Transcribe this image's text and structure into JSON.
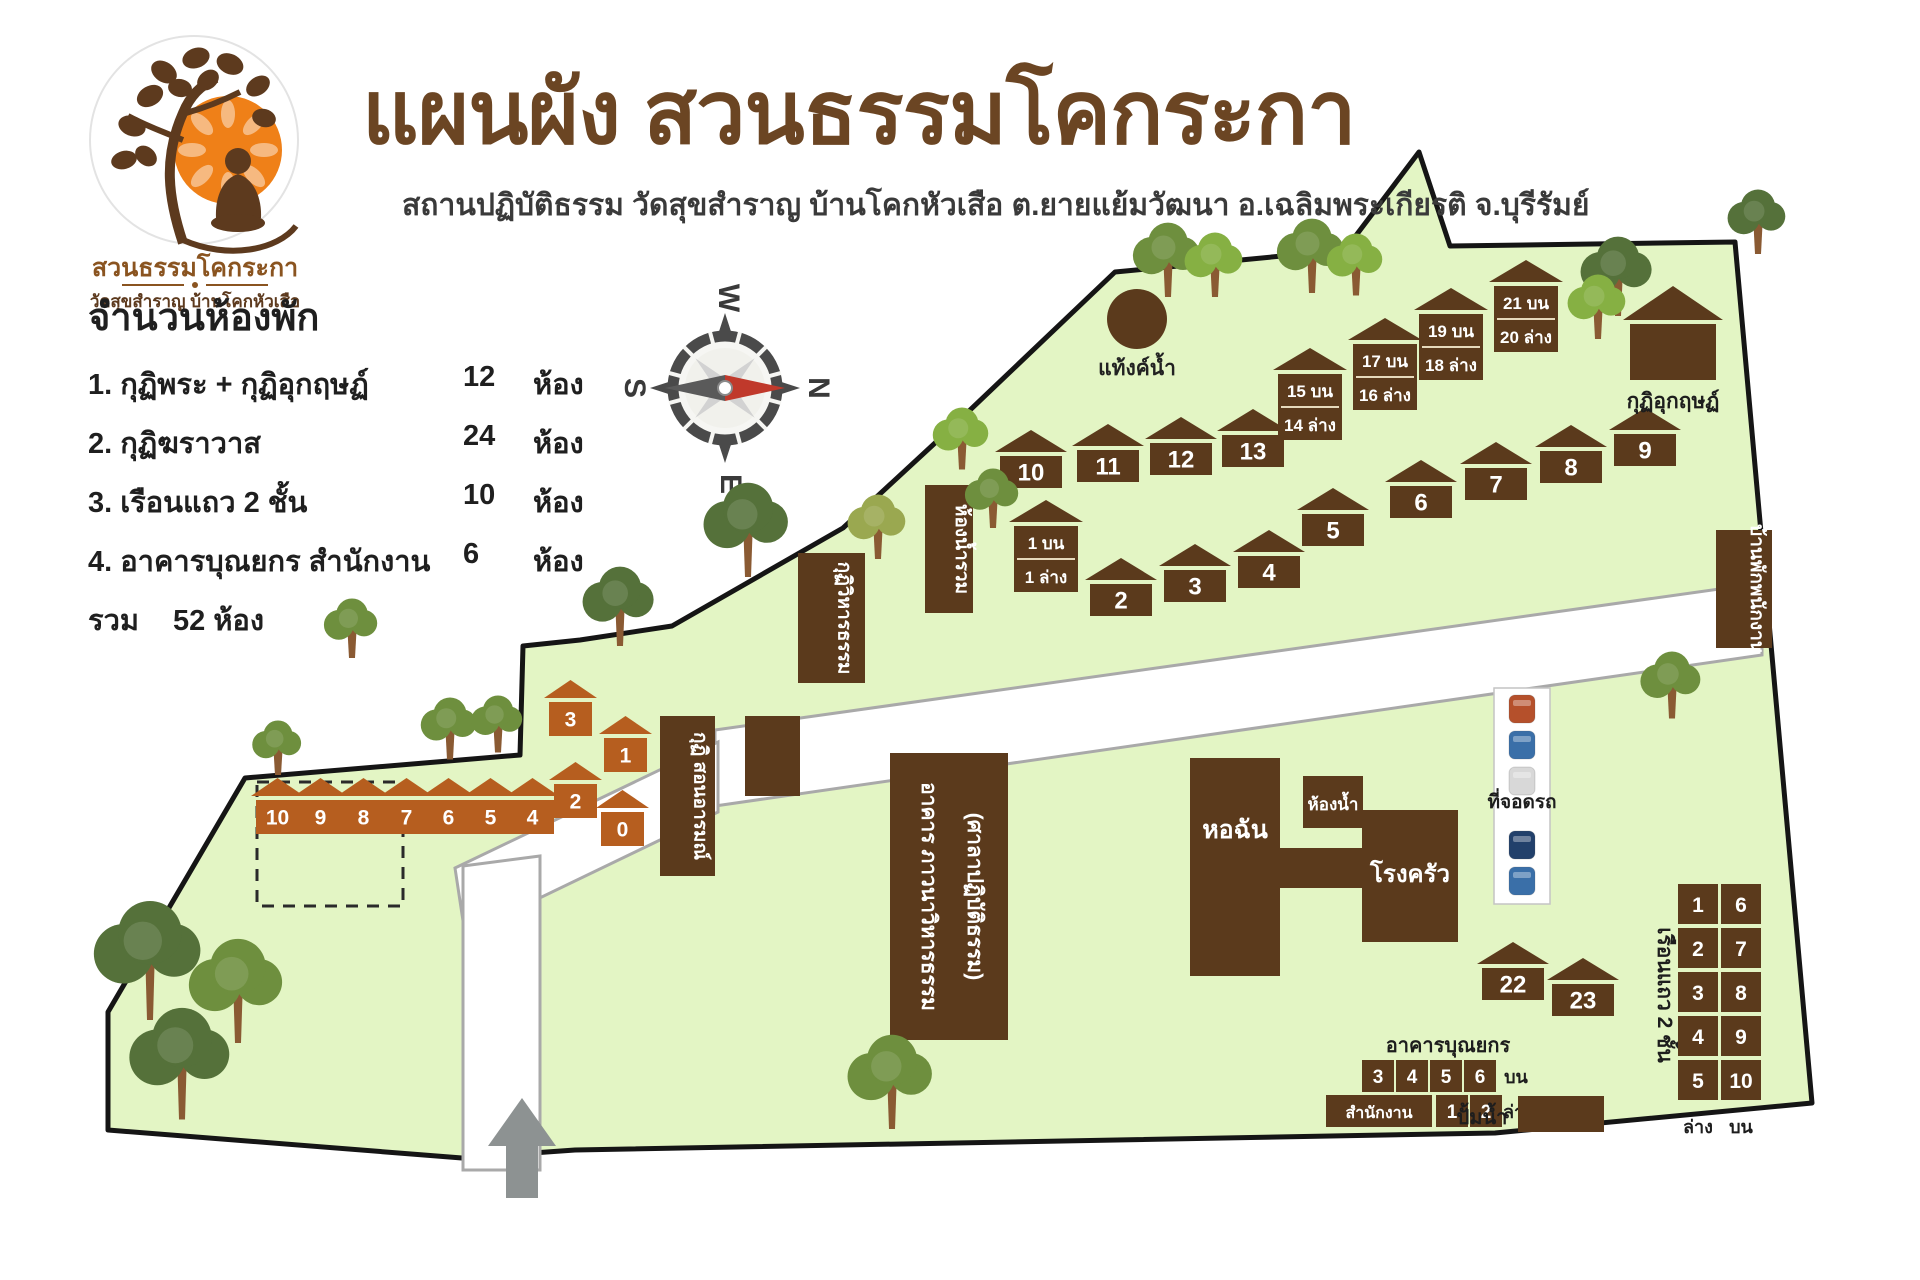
{
  "header": {
    "title": "แผนผัง สวนธรรมโคกระกา",
    "subtitle": "สถานปฏิบัติธรรม วัดสุขสำราญ บ้านโคกหัวเสือ ต.ยายแย้มวัฒนา อ.เฉลิมพระเกียรติ จ.บุรีรัมย์",
    "logo": {
      "name": "สวนธรรมโคกระกา",
      "sub": "วัดสุขสำราญ บ้านโคกหัวเสือ"
    }
  },
  "legend": {
    "title": "จำนวนห้องพัก",
    "items": [
      {
        "no": "1.",
        "label": "กุฏิพระ + กุฏิอุกฤษฏ์",
        "count": "12",
        "unit": "ห้อง"
      },
      {
        "no": "2.",
        "label": "กุฏิฆราวาส",
        "count": "24",
        "unit": "ห้อง"
      },
      {
        "no": "3.",
        "label": "เรือนแถว 2 ชั้น",
        "count": "10",
        "unit": "ห้อง"
      },
      {
        "no": "4.",
        "label": "อาคารบุณยกร สำนักงาน",
        "count": "6",
        "unit": "ห้อง"
      }
    ],
    "total_label": "รวม",
    "total_value": "52 ห้อง"
  },
  "compass": {
    "n": "N",
    "e": "E",
    "s": "S",
    "w": "W"
  },
  "colors": {
    "land": "#e3f5c4",
    "border": "#151515",
    "building": "#5b3a1c",
    "orange": "#b65e1f",
    "road": "#ffffff",
    "road_edge": "#a9a9a9",
    "title_brown": "#6b4523",
    "needle_red": "#c0392b",
    "tree_greens": [
      "#6e8f3e",
      "#86b043",
      "#55713a",
      "#9aa850"
    ],
    "trunk": "#8a5a33"
  },
  "map": {
    "tank": {
      "label": "แท้งค์น้ำ",
      "cx": 1137,
      "cy": 319,
      "r": 30
    },
    "houses": [
      {
        "n": "10",
        "x": 1000,
        "y": 430
      },
      {
        "n": "11",
        "x": 1077,
        "y": 424
      },
      {
        "n": "12",
        "x": 1150,
        "y": 417
      },
      {
        "n": "13",
        "x": 1222,
        "y": 409
      },
      {
        "n": "6",
        "x": 1390,
        "y": 460
      },
      {
        "n": "7",
        "x": 1465,
        "y": 442
      },
      {
        "n": "8",
        "x": 1540,
        "y": 425
      },
      {
        "n": "9",
        "x": 1614,
        "y": 408
      },
      {
        "n": "5",
        "x": 1302,
        "y": 488
      },
      {
        "n": "2",
        "x": 1090,
        "y": 558
      },
      {
        "n": "3",
        "x": 1164,
        "y": 544
      },
      {
        "n": "4",
        "x": 1238,
        "y": 530
      },
      {
        "n": "22",
        "x": 1482,
        "y": 942
      },
      {
        "n": "23",
        "x": 1552,
        "y": 958
      }
    ],
    "two_story": [
      {
        "top": "1 บน",
        "bottom": "1 ล่าง",
        "x": 1014,
        "y": 500
      },
      {
        "top": "15 บน",
        "bottom": "14 ล่าง",
        "x": 1278,
        "y": 348
      },
      {
        "top": "17 บน",
        "bottom": "16 ล่าง",
        "x": 1353,
        "y": 318
      },
      {
        "top": "19 บน",
        "bottom": "18 ล่าง",
        "x": 1419,
        "y": 288
      },
      {
        "top": "21 บน",
        "bottom": "20 ล่าง",
        "x": 1494,
        "y": 260
      }
    ],
    "orange_houses": [
      {
        "n": "10",
        "x": 256,
        "y": 778
      },
      {
        "n": "9",
        "x": 299,
        "y": 778
      },
      {
        "n": "8",
        "x": 342,
        "y": 778
      },
      {
        "n": "7",
        "x": 385,
        "y": 778
      },
      {
        "n": "6",
        "x": 427,
        "y": 778
      },
      {
        "n": "5",
        "x": 469,
        "y": 778
      },
      {
        "n": "4",
        "x": 511,
        "y": 778
      },
      {
        "n": "2",
        "x": 554,
        "y": 762
      },
      {
        "n": "0",
        "x": 601,
        "y": 790
      },
      {
        "n": "3",
        "x": 549,
        "y": 680
      },
      {
        "n": "1",
        "x": 604,
        "y": 716
      }
    ],
    "ukrit": {
      "label": "กุฏิอุกฤษฏ์",
      "x": 1630,
      "y": 286,
      "w": 86
    },
    "vertical_buildings": [
      {
        "label": "ห้องน้ำรวม",
        "x": 925,
        "y": 485,
        "w": 48,
        "h": 128
      },
      {
        "label": "กุฏิวิหารธรรม",
        "x": 798,
        "y": 553,
        "w": 67,
        "h": 130
      },
      {
        "label": "กุฏิ สอนอารมณ์",
        "x": 660,
        "y": 716,
        "w": 55,
        "h": 160
      },
      {
        "label": "",
        "x": 745,
        "y": 716,
        "w": 55,
        "h": 80
      },
      {
        "label": "บ้านพักพนักงาน",
        "x": 1716,
        "y": 530,
        "w": 56,
        "h": 118
      }
    ],
    "hall": {
      "line1": "อาคาร ภาวนาวิหารธรรม",
      "line2": "(ศาลาปฏิบัติธรรม)",
      "x": 890,
      "y": 753,
      "w": 118,
      "h": 287
    },
    "dining_hall": {
      "label": "หอฉัน",
      "x": 1190,
      "y": 758,
      "w": 90,
      "h": 218
    },
    "kitchen": {
      "label": "โรงครัว",
      "x": 1362,
      "y": 810,
      "w": 96,
      "h": 132
    },
    "bathroom": {
      "label": "ห้องน้ำ",
      "x": 1303,
      "y": 776,
      "w": 60,
      "h": 52
    },
    "corridor": {
      "x": 1278,
      "y": 848,
      "w": 86,
      "h": 40
    },
    "parking": {
      "label": "ที่จอดรถ",
      "x": 1522,
      "cars": [
        {
          "y": 695,
          "c": "#b5502b"
        },
        {
          "y": 731,
          "c": "#3a6fa8"
        },
        {
          "y": 767,
          "c": "#d8d8d8"
        },
        {
          "y": 831,
          "c": "#22406b"
        },
        {
          "y": 867,
          "c": "#3a6fa8"
        }
      ]
    },
    "bunyakorn": {
      "title": "อาคารบุณยกร",
      "top_cells": [
        "3",
        "4",
        "5",
        "6"
      ],
      "top_note": "บน",
      "office": "สำนักงาน",
      "bottom_cells": [
        "1",
        "2"
      ],
      "bottom_note": "ล่าง"
    },
    "rowhouse": {
      "label": "เรือนแถว 2 ชั้น",
      "left_cells": [
        "1",
        "2",
        "3",
        "4",
        "5"
      ],
      "right_cells": [
        "6",
        "7",
        "8",
        "9",
        "10"
      ],
      "left_note": "ล่าง",
      "right_note": "บน"
    },
    "pump": {
      "label": "ปั้มน้ำ"
    },
    "trees": [
      {
        "x": 1168,
        "y": 252,
        "s": 30,
        "c": 0
      },
      {
        "x": 1215,
        "y": 258,
        "s": 26,
        "c": 1
      },
      {
        "x": 1312,
        "y": 248,
        "s": 30,
        "c": 0
      },
      {
        "x": 1356,
        "y": 258,
        "s": 25,
        "c": 1
      },
      {
        "x": 1618,
        "y": 268,
        "s": 32,
        "c": 2
      },
      {
        "x": 1598,
        "y": 300,
        "s": 26,
        "c": 1
      },
      {
        "x": 962,
        "y": 432,
        "s": 25,
        "c": 1
      },
      {
        "x": 993,
        "y": 492,
        "s": 24,
        "c": 0
      },
      {
        "x": 878,
        "y": 520,
        "s": 26,
        "c": 3
      },
      {
        "x": 748,
        "y": 520,
        "s": 38,
        "c": 2
      },
      {
        "x": 620,
        "y": 598,
        "s": 32,
        "c": 2
      },
      {
        "x": 352,
        "y": 622,
        "s": 24,
        "c": 0
      },
      {
        "x": 278,
        "y": 742,
        "s": 22,
        "c": 0
      },
      {
        "x": 450,
        "y": 722,
        "s": 25,
        "c": 0
      },
      {
        "x": 498,
        "y": 718,
        "s": 23,
        "c": 0
      },
      {
        "x": 150,
        "y": 948,
        "s": 48,
        "c": 2
      },
      {
        "x": 238,
        "y": 980,
        "s": 42,
        "c": 0
      },
      {
        "x": 182,
        "y": 1052,
        "s": 45,
        "c": 2
      },
      {
        "x": 892,
        "y": 1072,
        "s": 38,
        "c": 0
      },
      {
        "x": 1672,
        "y": 678,
        "s": 27,
        "c": 0
      },
      {
        "x": 1758,
        "y": 215,
        "s": 26,
        "c": 2
      }
    ]
  }
}
